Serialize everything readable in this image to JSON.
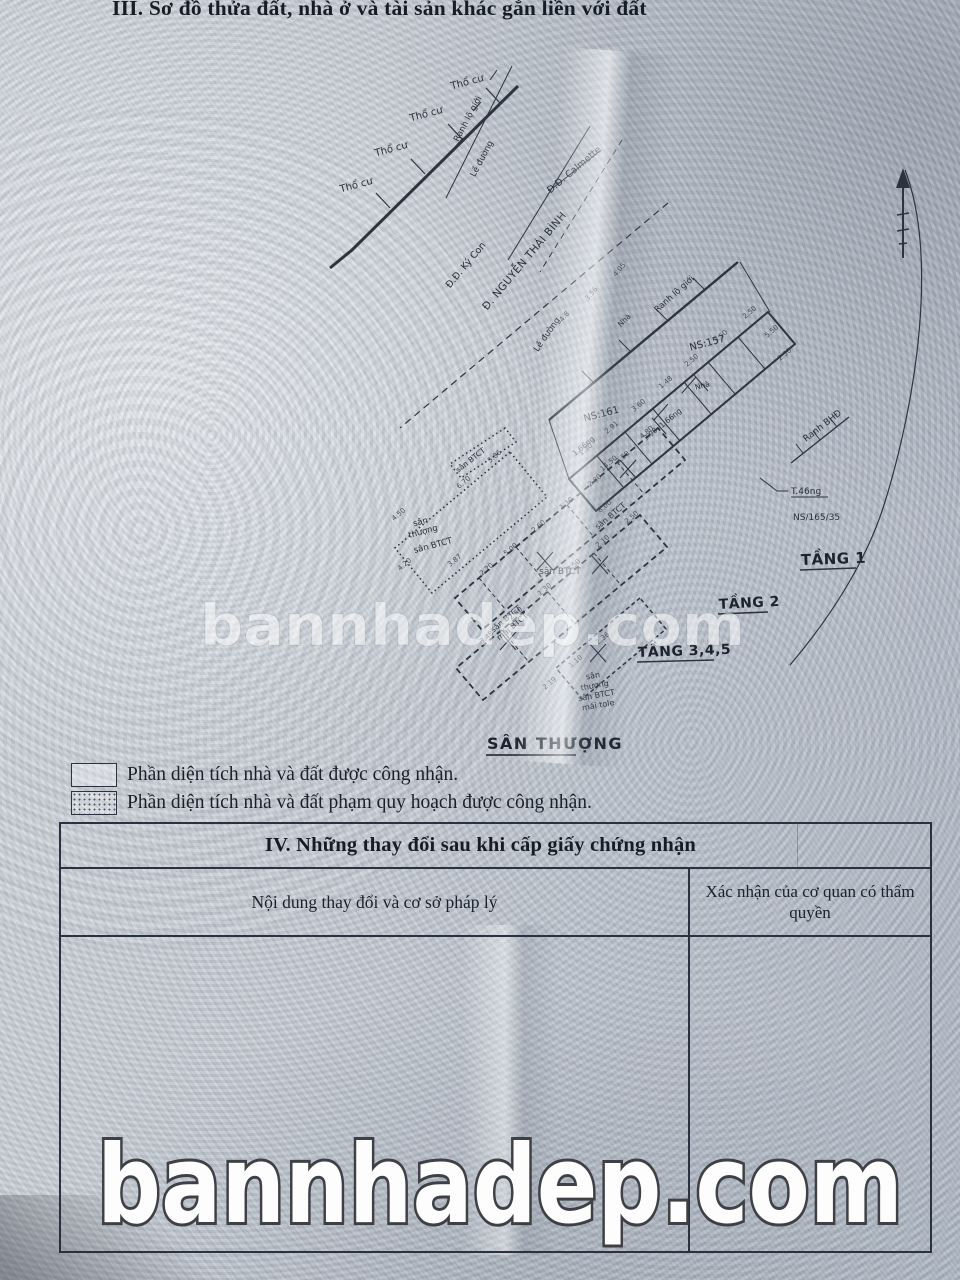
{
  "page_title": "III. Sơ đồ thửa đất, nhà ở và tài sản khác gắn liền với đất",
  "watermark": {
    "text": "bannhadep.com"
  },
  "diagram": {
    "land": {
      "tho_cu": "Thổ cư"
    },
    "boundary": {
      "ranh_lo_gioi": "Ranh lộ giới",
      "le_duong": "Lề đường",
      "ranh_bhd": "Ranh BHĐ"
    },
    "streets": {
      "ky_con": "Đ.Đ. Ký Con",
      "calmette": "Đ.Đ. Calmette",
      "nguyen_thai_binh": "Đ. NGUYỄN THÁI BÌNH"
    },
    "parcels": {
      "ns157": "NS:157",
      "ns161": "NS:161",
      "ns165_35": "NS/165/35",
      "t46ng": "T.46ng",
      "ng1_66": "1.66ng"
    },
    "floors": {
      "tang1": "TẦNG 1",
      "tang2": "TẦNG 2",
      "tang345": "TẦNG 3,4,5",
      "san_thuong": "SÂN THƯỢNG"
    },
    "surfaces": {
      "san": "sân",
      "thuong": "thượng",
      "san_btct": "sân BTCT",
      "mai_btct": "mái BTCT",
      "mai_tole": "mái tole",
      "nha": "Nhà"
    },
    "dimensions": [
      {
        "t": "2.50",
        "x": 751,
        "y": 314,
        "r": -40
      },
      {
        "t": "3.50",
        "x": 722,
        "y": 338,
        "r": -40
      },
      {
        "t": "2.50",
        "x": 693,
        "y": 362,
        "r": -40
      },
      {
        "t": "1.48",
        "x": 667,
        "y": 384,
        "r": -40
      },
      {
        "t": "3.60",
        "x": 640,
        "y": 407,
        "r": -40
      },
      {
        "t": "2.91",
        "x": 613,
        "y": 429,
        "r": -40
      },
      {
        "t": "1.30",
        "x": 587,
        "y": 451,
        "r": -40
      },
      {
        "t": "14.50",
        "x": 610,
        "y": 465,
        "r": -40
      },
      {
        "t": "4.80",
        "x": 648,
        "y": 434,
        "r": -40
      },
      {
        "t": "5.50",
        "x": 773,
        "y": 333,
        "r": -40
      },
      {
        "t": "2.30",
        "x": 786,
        "y": 356,
        "r": -40
      },
      {
        "t": "4.05",
        "x": 621,
        "y": 271,
        "r": -50
      },
      {
        "t": "3.56",
        "x": 593,
        "y": 295,
        "r": -50
      },
      {
        "t": "4.8",
        "x": 566,
        "y": 318,
        "r": -50
      },
      {
        "t": "3.98",
        "x": 652,
        "y": 436,
        "r": -40
      },
      {
        "t": "2.50",
        "x": 624,
        "y": 459,
        "r": -40
      },
      {
        "t": "2.80",
        "x": 596,
        "y": 482,
        "r": -40
      },
      {
        "t": "1.10",
        "x": 568,
        "y": 505,
        "r": -40
      },
      {
        "t": "2.60",
        "x": 540,
        "y": 528,
        "r": -40
      },
      {
        "t": "5.00",
        "x": 512,
        "y": 551,
        "r": -40
      },
      {
        "t": "2.20",
        "x": 488,
        "y": 571,
        "r": -40
      },
      {
        "t": "8.00",
        "x": 606,
        "y": 508,
        "r": -40
      },
      {
        "t": "5.86",
        "x": 496,
        "y": 458,
        "r": -40
      },
      {
        "t": "6.70",
        "x": 465,
        "y": 484,
        "r": -40
      },
      {
        "t": "4.50",
        "x": 400,
        "y": 516,
        "r": -40
      },
      {
        "t": "4.20",
        "x": 406,
        "y": 566,
        "r": -40
      },
      {
        "t": "3.87",
        "x": 456,
        "y": 562,
        "r": -40
      },
      {
        "t": "2.50",
        "x": 633,
        "y": 519,
        "r": -40
      },
      {
        "t": "2.10",
        "x": 604,
        "y": 543,
        "r": -40
      },
      {
        "t": "3.50",
        "x": 575,
        "y": 567,
        "r": -40
      },
      {
        "t": "1.30",
        "x": 546,
        "y": 591,
        "r": -40
      },
      {
        "t": "2.50",
        "x": 517,
        "y": 615,
        "r": -40
      },
      {
        "t": "3.48",
        "x": 488,
        "y": 639,
        "r": -40
      },
      {
        "t": "2.36",
        "x": 604,
        "y": 640,
        "r": -40
      },
      {
        "t": "1.10",
        "x": 577,
        "y": 663,
        "r": -40
      },
      {
        "t": "2.19",
        "x": 551,
        "y": 685,
        "r": -40
      }
    ]
  },
  "legend": {
    "items": [
      {
        "label": "Phần diện tích nhà và đất được công nhận."
      },
      {
        "label": "Phần diện tích nhà và đất phạm quy hoạch được công nhận."
      }
    ]
  },
  "section_iv": {
    "title": "IV. Những thay đổi sau khi cấp giấy chứng nhận",
    "col_left": "Nội dung thay đổi và cơ sở pháp lý",
    "col_right": "Xác nhận của cơ quan có thẩm quyền"
  }
}
